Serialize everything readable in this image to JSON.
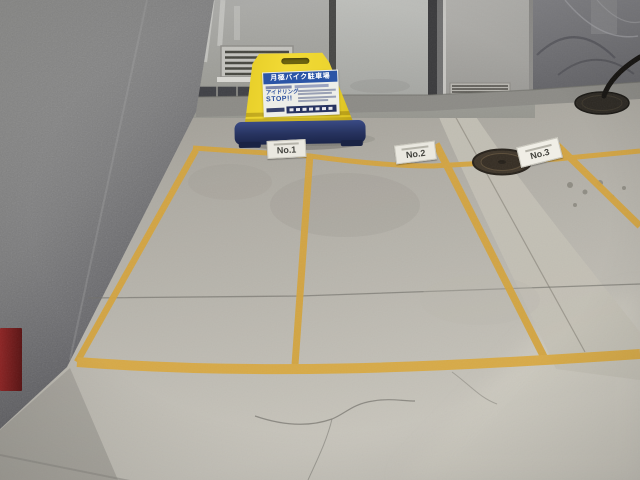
{
  "scene": {
    "type": "photograph",
    "setting": "Indoor monthly motorcycle parking bay with yellow-marked numbered spaces",
    "sign": {
      "title": "月極バイク駐車場",
      "idling_line1": "アイドリング",
      "idling_line2": "STOP!!"
    },
    "space_markers": [
      {
        "label": "No.1"
      },
      {
        "label": "No.2"
      },
      {
        "label": "No.3"
      }
    ],
    "colors": {
      "line_yellow": "#d4a43e",
      "sign_yellow": "#eed431",
      "sign_base_blue": "#2c3f7e",
      "sign_header_blue": "#2b55a6",
      "floor_gray": "#b3b0a8",
      "wall_gray": "#7e7e80",
      "red_object": "#8e2222"
    }
  }
}
